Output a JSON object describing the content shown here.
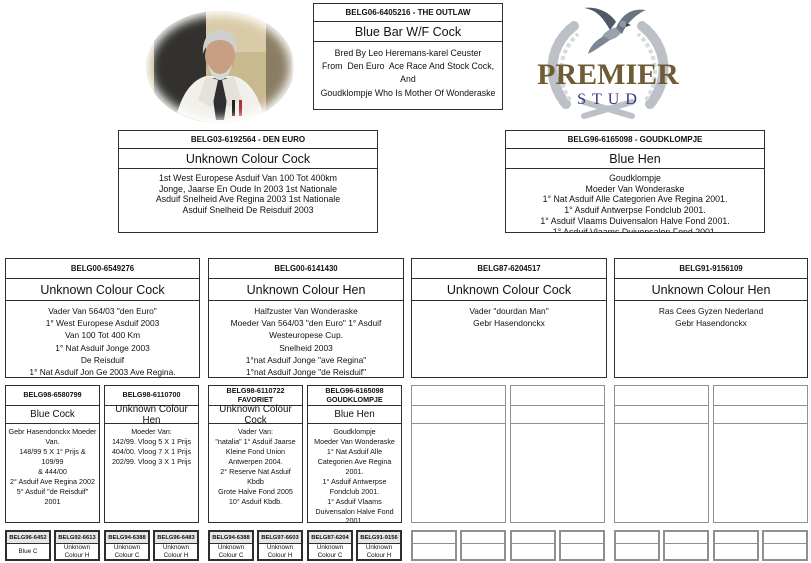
{
  "logo": {
    "premier": "PREMIER",
    "stud": "STUD",
    "premier_color": "#6e5c35",
    "stud_color": "#39347c",
    "wreath_color": "#bcc1c7"
  },
  "main": {
    "ring": "BELG06-6405216 - THE OUTLAW",
    "colour": "Blue Bar W/F Cock",
    "note": "Bred By Leo Heremans-karel Ceuster\nFrom  Den Euro  Ace Race And Stock Cock, And\nGoudklompje Who Is Mother Of Wonderaske"
  },
  "gen2": [
    {
      "ring": "BELG03-6192564 - DEN EURO",
      "colour": "Unknown Colour Cock",
      "note": "1st West Europese Asduif Van 100 Tot 400km\nJonge, Jaarse En Oude In 2003 1st Nationale\nAsduif Snelheid Ave Regina 2003 1st Nationale\nAsduif Snelheid De Reisduif 2003"
    },
    {
      "ring": "BELG96-6165098 - GOUDKLOMPJE",
      "colour": "Blue Hen",
      "note": "Goudklompje\nMoeder Van Wonderaske\n1° Nat Asduif Alle Categorien Ave Regina 2001.\n1° Asduif Antwerpse Fondclub 2001.\n1° Asduif Vlaams Duivensalon Halve Fond 2001.\n1° Asduif Vlaams Duivensalon Fond 2001."
    }
  ],
  "gen3": [
    {
      "ring": "BELG00-6549276",
      "colour": "Unknown Colour Cock",
      "note": "Vader Van 564/03 \"den Euro\"\n1° West Europese Asduif 2003\nVan 100 Tot 400 Km\n1° Nat Asduif Jonge 2003\nDe Reisduif\n1° Nat Asduif Jon Ge 2003 Ave Regina."
    },
    {
      "ring": "BELG00-6141430",
      "colour": "Unknown Colour Hen",
      "note": "Halfzuster Van Wonderaske\nMoeder Van 564/03 \"den Euro\" 1° Asduif\nWesteuropese Cup.\nSnelheid 2003\n1°nat Asduif Jonge \"ave Regina\"\n1°nat Asduif Jonge \"de Reisduif\""
    },
    {
      "ring": "BELG87-6204517",
      "colour": "Unknown Colour Cock",
      "note": "Vader \"dourdan Man\"\nGebr Hasendonckx"
    },
    {
      "ring": "BELG91-9156109",
      "colour": "Unknown Colour Hen",
      "note": "Ras Cees Gyzen Nederland\nGebr Hasendonckx"
    }
  ],
  "gen4": [
    {
      "ring": "BELG98-6580799",
      "colour": "Blue Cock",
      "note": "Gebr Hasendonckx Moeder\nVan.\n148/99 5 X 1° Prijs & 109/99\n& 444/00\n2° Asduif Ave Regina 2002\n5° Asduif \"de Reisduif\" 2001"
    },
    {
      "ring": "BELG98-6110700",
      "colour": "Unknown Colour Hen",
      "note": "Moeder Van:\n142/99. Vloog 5 X 1 Prijs\n404/00. Vloog 7 X 1 Prijs\n202/99. Vloog 3 X 1 Prijs"
    },
    {
      "ring": "BELG98-6110722\nFAVORIET",
      "colour": "Unknown Colour Cock",
      "note": "Vader Van:\n\"natalia\" 1° Asduif Jaarse\nKleine Fond Union\nAntwerpen 2004.\n2° Reserve Nat Asduif Kbdb\nGrote Halve Fond 2005\n10° Asduif Kbdb."
    },
    {
      "ring": "BELG96-6165098\nGOUDKLOMPJE",
      "colour": "Blue Hen",
      "note": "Goudklompje\nMoeder Van Wonderaske\n1° Nat Asduif Alle\nCategorien Ave Regina\n2001.\n1° Asduif Antwerpse\nFondclub 2001.\n1° Asduif Vlaams\nDuivensalon Halve Fond\n2001.\n1° Asduif Vlaams"
    },
    {
      "ring": "",
      "colour": "",
      "note": ""
    },
    {
      "ring": "",
      "colour": "",
      "note": ""
    },
    {
      "ring": "",
      "colour": "",
      "note": ""
    },
    {
      "ring": "",
      "colour": "",
      "note": ""
    }
  ],
  "gen5": [
    {
      "ring": "BELG96-6452",
      "colour": "Blue C"
    },
    {
      "ring": "BELG92-6613",
      "colour": "Unknown Colour H"
    },
    {
      "ring": "BELG94-6388",
      "colour": "Unknown Colour C"
    },
    {
      "ring": "BELG96-6483",
      "colour": "Unknown Colour H"
    },
    {
      "ring": "BELG94-6388",
      "colour": "Unknown Colour C"
    },
    {
      "ring": "BELG97-6603",
      "colour": "Unknown Colour H"
    },
    {
      "ring": "BELG87-6204",
      "colour": "Unknown Colour C"
    },
    {
      "ring": "BELG91-9156",
      "colour": "Unknown Colour H"
    },
    {
      "ring": "",
      "colour": ""
    },
    {
      "ring": "",
      "colour": ""
    },
    {
      "ring": "",
      "colour": ""
    },
    {
      "ring": "",
      "colour": ""
    },
    {
      "ring": "",
      "colour": ""
    },
    {
      "ring": "",
      "colour": ""
    },
    {
      "ring": "",
      "colour": ""
    },
    {
      "ring": "",
      "colour": ""
    }
  ]
}
